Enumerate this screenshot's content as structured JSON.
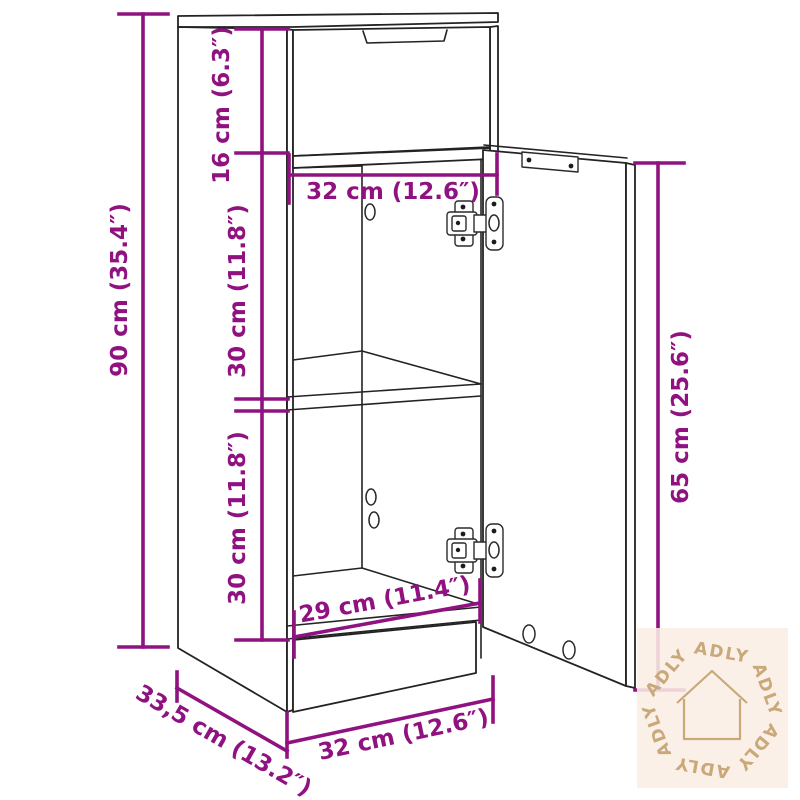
{
  "diagram": {
    "title": "Cabinet dimension diagram",
    "background": "#ffffff",
    "line_color": "#232323",
    "dimension_color": "#8F1280",
    "dimensions": {
      "drawer_height": "16 cm (6.3″)",
      "inner_width_top": "32 cm (12.6″)",
      "total_height": "90 cm (35.4″)",
      "compartment_upper_height": "30 cm (11.8″)",
      "compartment_lower_height": "30 cm (11.8″)",
      "door_height": "65 cm (25.6″)",
      "inner_width_bottom": "29 cm (11.4″)",
      "depth": "33,5 cm (13.2″)",
      "outer_width_bottom": "32 cm (12.6″)"
    }
  },
  "watermark": {
    "brand": "ADLY",
    "icon": "house-icon",
    "text_color": "#C9A87A",
    "background": "#FBEEE4"
  }
}
